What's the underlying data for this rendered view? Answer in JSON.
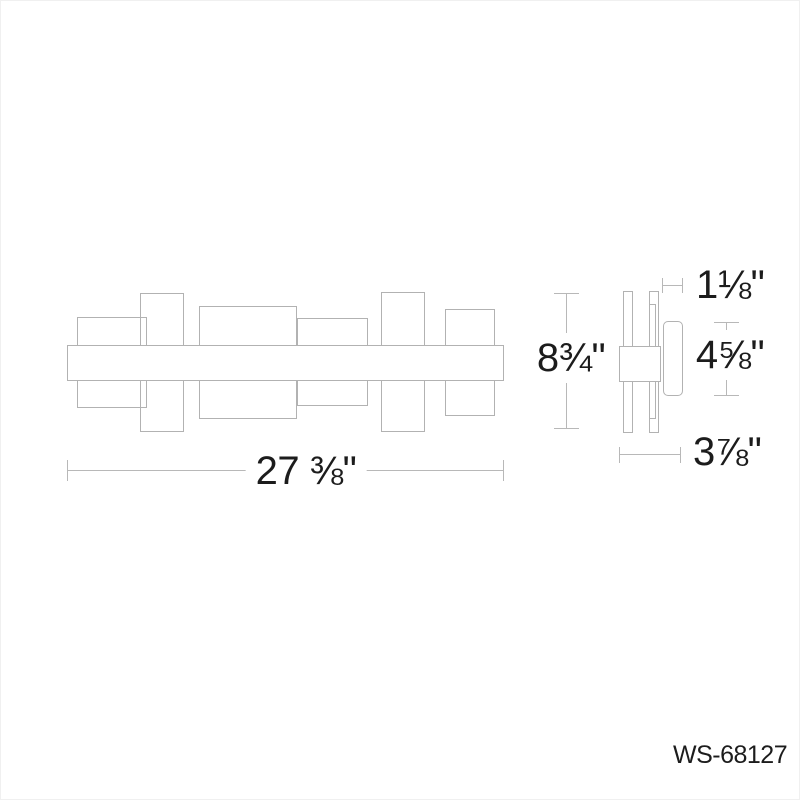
{
  "product": {
    "model": "WS-68127"
  },
  "dims": {
    "width": "27 ⅜\"",
    "height": "8¾\"",
    "top_depth": "1⅛\"",
    "glass_height": "4⅝\"",
    "depth": "3⅞\""
  },
  "colors": {
    "drawing_line": "#b2b2b2",
    "dimension_line": "#b8b8b8",
    "text": "#1c1c1c",
    "background": "#ffffff"
  }
}
